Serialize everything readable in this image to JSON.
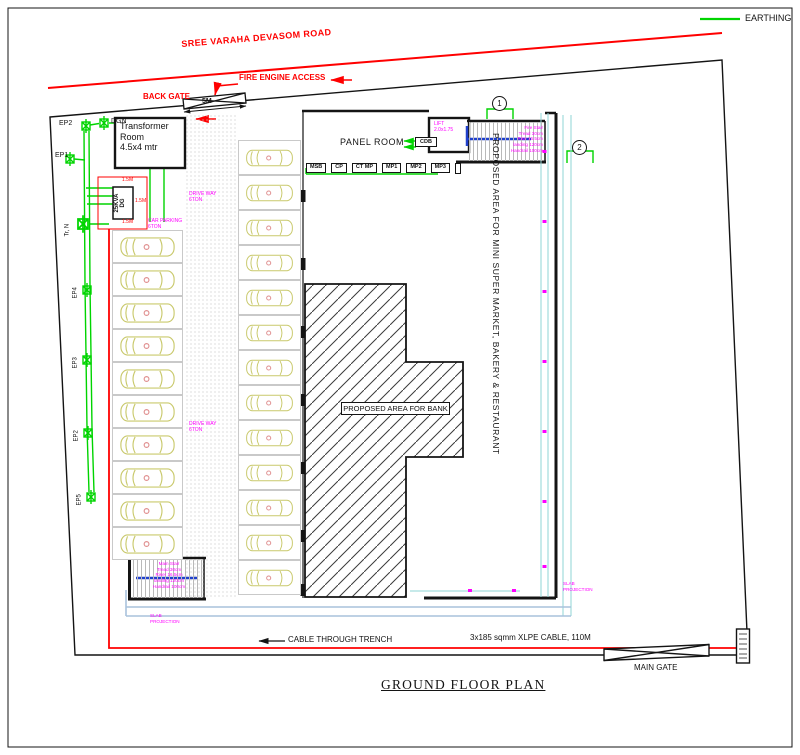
{
  "colors": {
    "red": "#ff0000",
    "green": "#00d400",
    "magenta": "#ff00ff",
    "car": "#c9c96c",
    "cyan": "#8fd6d6",
    "steel": "#a9c2dc",
    "blue": "#2040cc",
    "ink": "#141414",
    "gray": "#c9c9c9"
  },
  "legend": {
    "earthing": "EARTHING"
  },
  "road": {
    "name": "SREE VARAHA DEVASOM ROAD"
  },
  "gates": {
    "back_gate": "BACK GATE",
    "back_gate_width": "5M",
    "fire_engine_access": "FIRE ENGINE ACCESS",
    "main_gate": "MAIN GATE"
  },
  "cables": {
    "trench": "CABLE THROUGH TRENCH",
    "xlpe": "3x185 sqmm XLPE CABLE, 110M"
  },
  "title": "GROUND FLOOR PLAN",
  "transformer_room": {
    "lines": [
      "Transformer",
      "Room",
      "4.5x4 mtr"
    ]
  },
  "dg": {
    "lines": [
      "25KVA",
      "DG"
    ],
    "dim_top": "1.5M",
    "dim_right": "1.5M",
    "dim_bottom": "1.5M"
  },
  "earthing_points": {
    "ep2_top": "EP2",
    "dgn": "DGN",
    "ep1": "EP1",
    "tr_n": "Tr, N",
    "ep4": "EP4",
    "ep3": "EP3",
    "ep2": "EP2",
    "ep5": "EP5"
  },
  "panel_room": {
    "label": "PANEL ROOM",
    "panels": [
      "MSB",
      "CP",
      "CT MP",
      "MP1",
      "MP2",
      "MP3"
    ]
  },
  "lift": {
    "lines": [
      "LIFT",
      "2.0x1.75"
    ]
  },
  "cdb": {
    "label": "CDB"
  },
  "stairs": {
    "fire": [
      "Fire Stair",
      "Tread 30cm",
      "Rise 16.5cm",
      "landing 120cm",
      "Handrail 100cm"
    ],
    "main": [
      "Main Stair",
      "Tread 30cm",
      "Riser 16.5cm",
      "landing 120cm",
      "Handrail 100cm"
    ]
  },
  "areas": {
    "bank": "PROPOSED AREA FOR BANK",
    "market": "PROPOSED AREA FOR MINI SUPER MARKET, BAKERY & RESTAURANT"
  },
  "parking": {
    "car_parking": [
      "CAR PARKING",
      "6TON"
    ],
    "drive_way": [
      "DRIVE WAY",
      "6TON"
    ],
    "left_count": 10,
    "middle_count": 13
  },
  "slab_projection": [
    "SLAB",
    "PROJECTION"
  ],
  "markers": {
    "m1": "1",
    "m2": "2"
  }
}
